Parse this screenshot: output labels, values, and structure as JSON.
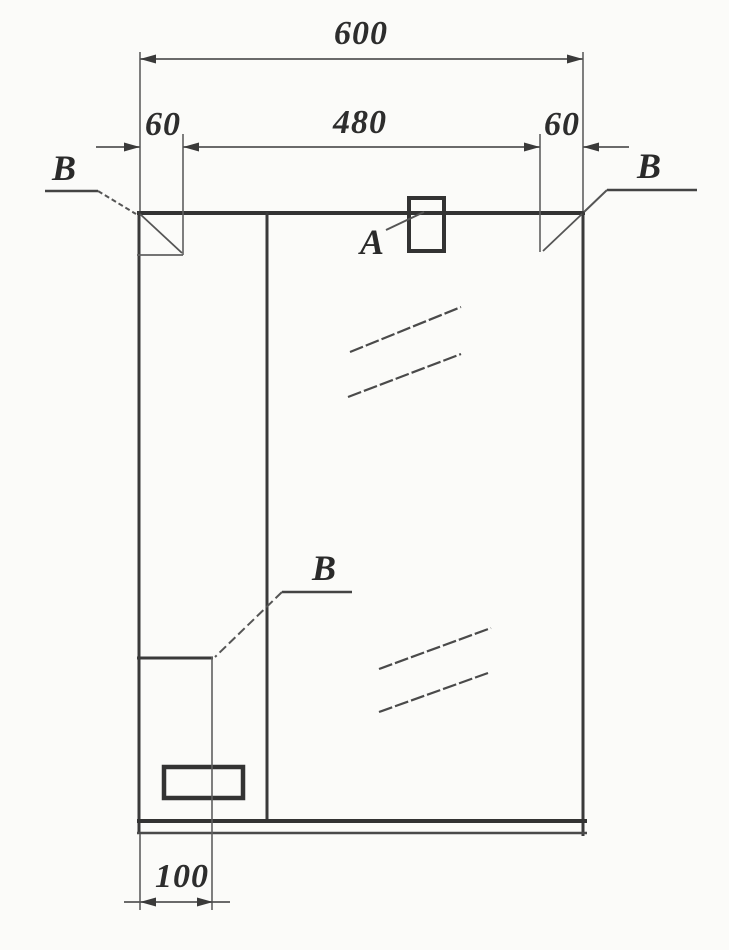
{
  "drawing": {
    "dimensions": {
      "overall_width": "600",
      "left_offset": "60",
      "center_span": "480",
      "right_offset": "60",
      "door_width": "100"
    },
    "markers": {
      "lamp": "A",
      "left_corner": "B",
      "right_corner": "B",
      "door_corner": "B"
    },
    "colors": {
      "line_dark": "#333333",
      "line_thin": "#606060",
      "text": "#2d2d2d",
      "background": "#fbfbf9"
    }
  }
}
